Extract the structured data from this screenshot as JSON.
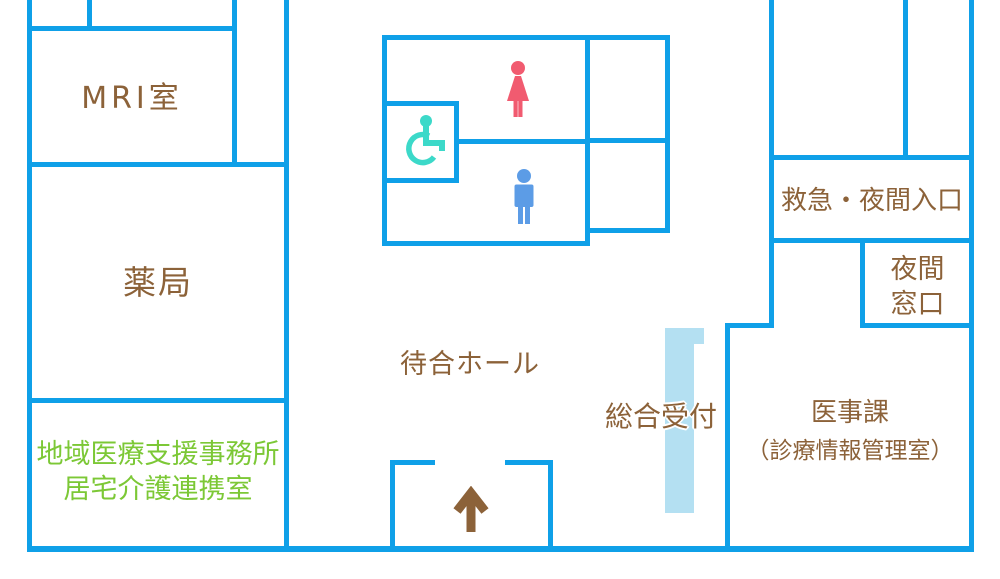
{
  "colors": {
    "wall": "#0FA0E8",
    "label_brown": "#8C6239",
    "label_green": "#7CC836",
    "reception_counter": "#B4E0F2",
    "female_icon": "#F15B70",
    "male_icon": "#5C9CE6",
    "wheelchair_icon": "#3CD9C9",
    "arrow_icon": "#8C6239"
  },
  "rooms": {
    "mri": {
      "label": "MRI室"
    },
    "pharmacy": {
      "label": "薬局"
    },
    "community_office": {
      "line1": "地域医療支援事務所",
      "line2": "居宅介護連携室"
    },
    "waiting_hall": {
      "label": "待合ホール"
    },
    "reception": {
      "label": "総合受付"
    },
    "medical_affairs": {
      "line1": "医事課",
      "line2": "（診療情報管理室）"
    },
    "emergency_entrance": {
      "label": "救急・夜間入口"
    },
    "night_window": {
      "line1": "夜間",
      "line2": "窓口"
    }
  },
  "icons": {
    "female": "female-restroom-icon",
    "male": "male-restroom-icon",
    "wheelchair": "wheelchair-accessible-icon",
    "entrance_arrow": "up-arrow-icon"
  }
}
